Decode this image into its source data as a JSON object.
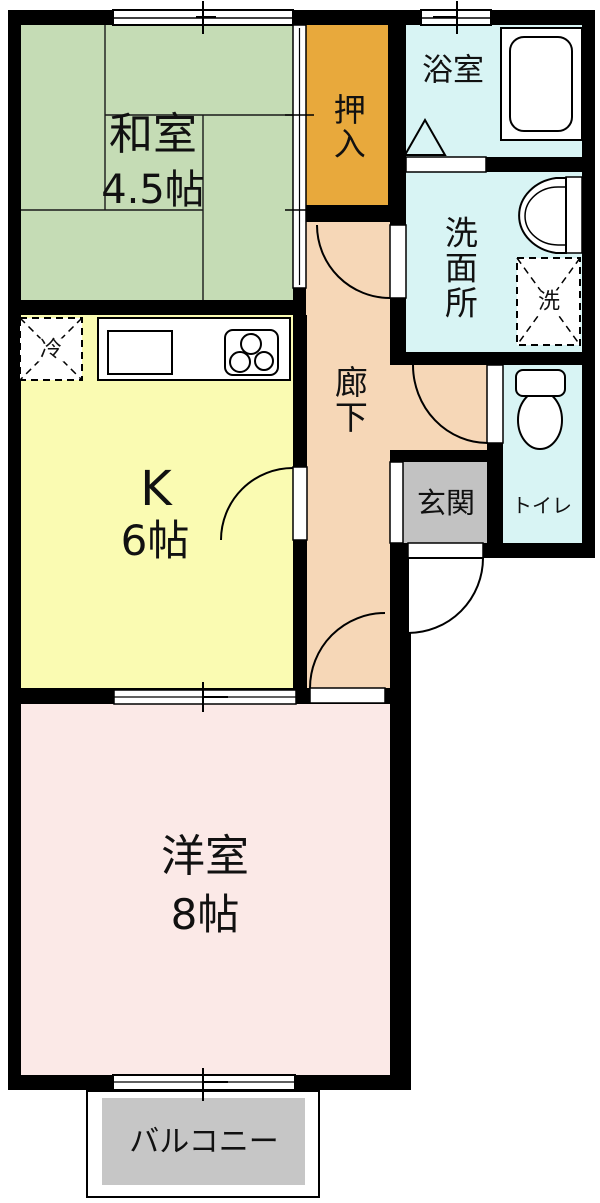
{
  "floorplan": {
    "title": "1K apartment floor plan",
    "rooms": {
      "washitsu": {
        "name": "和室",
        "size": "4.5帖"
      },
      "oshiire": {
        "name": "押入"
      },
      "yokushitsu": {
        "name": "浴室"
      },
      "senmenjo": {
        "name": "洗面所"
      },
      "rouka": {
        "name": "廊下"
      },
      "kitchen": {
        "name": "K",
        "size": "6帖"
      },
      "genkan": {
        "name": "玄関"
      },
      "toilet": {
        "name": "トイレ"
      },
      "youshitsu": {
        "name": "洋室",
        "size": "8帖"
      },
      "balcony": {
        "name": "バルコニー"
      }
    },
    "appliances": {
      "refrigerator": "冷",
      "washer": "洗"
    },
    "colors": {
      "wall": "#000000",
      "washitsu": "#c5dcb5",
      "oshiire": "#e8a93c",
      "wet_rooms": "#d8f4f4",
      "corridor": "#f6d7b7",
      "kitchen": "#fafbb2",
      "genkan": "#c2c2c2",
      "youshitsu": "#fbe9e7",
      "balcony": "#c6c6c6"
    }
  }
}
